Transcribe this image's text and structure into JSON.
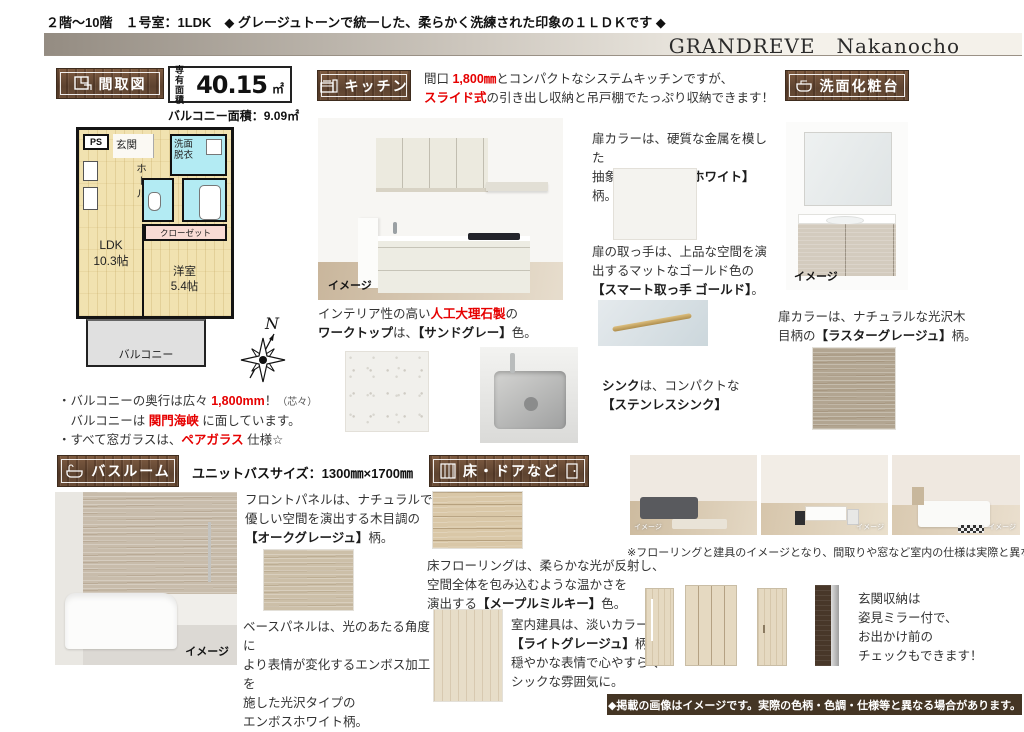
{
  "page": {
    "top_header": "２階～10階　１号室：1LDK　◆ グレージュトーンで統一した、柔らかく洗練された印象の１ＬＤＫです ◆",
    "title": "GRANDREVE　Nakanocho",
    "footer_note": "◆掲載の画像はイメージです。実際の色柄・色調・仕様等と異なる場合があります。",
    "image_label": "イメージ",
    "colors": {
      "accent_red": "#e60000",
      "plaque_wood": "#6b4a33",
      "footer_bg": "#443524"
    }
  },
  "floorplan": {
    "header": "間取図",
    "area_label": "専有\n面積",
    "area_value": "40.15",
    "area_unit": "㎡",
    "balcony_area": "バルコニー面積：9.09㎡",
    "rooms": {
      "ps": "PS",
      "genkan": "玄関",
      "hall": "ホール",
      "washroom": "洗面\n脱衣",
      "closet": "クローゼット",
      "ldk": "LDK\n10.3帖",
      "bedroom": "洋室\n5.4帖",
      "balcony": "バルコニー"
    },
    "compass": "N",
    "notes": {
      "n1_pre": "・バルコニーの奥行は広々 ",
      "n1_red": "1,800mm",
      "n1_post": "！",
      "n1_small": "（芯々）",
      "n2_pre": "　バルコニーは ",
      "n2_red": "関門海峡",
      "n2_post": " に面しています。",
      "n3_pre": "・すべて窓ガラスは、",
      "n3_red": "ペアガラス",
      "n3_post": " 仕様☆"
    }
  },
  "kitchen": {
    "header": "キッチン",
    "intro": {
      "pre": "間口 ",
      "red1": "1,800㎜",
      "mid": "とコンパクトなシステムキッチンですが、",
      "red2": "スライド式",
      "post": "の引き出し収納と吊戸棚でたっぷり収納できます！"
    },
    "worktop": {
      "l1_pre": "インテリア性の高い",
      "l1_red": "人工大理石製",
      "l1_post": "の",
      "l2_b1": "ワークトップ",
      "l2_m": "は、",
      "l2_b2": "【サンドグレー】",
      "l2_post": "色。"
    },
    "door": {
      "l1": "扉カラーは、硬質な金属を模した",
      "l2_pre": "抽象柄の",
      "l2_b": "【モードホワイト】",
      "l2_post": "柄。"
    },
    "handle": {
      "l1": "扉の取っ手は、上品な空間を演",
      "l2": "出するマットなゴールド色の",
      "l3_b": "【スマート取っ手 ゴールド】",
      "l3_post": "。"
    },
    "sink": {
      "b1": "シンク",
      "m": "は、コンパクトな",
      "b2": "【ステンレスシンク】"
    }
  },
  "vanity": {
    "header": "洗面化粧台",
    "door": {
      "l1": "扉カラーは、ナチュラルな光沢木",
      "l2_pre": "目柄の",
      "l2_b": "【ラスターグレージュ】",
      "l2_post": "柄。"
    }
  },
  "bathroom": {
    "header": "バスルーム",
    "size": "ユニットバスサイズ：1300㎜×1700㎜",
    "front": {
      "l1": "フロントパネルは、ナチュラルで",
      "l2": "優しい空間を演出する木目調の",
      "l3_b": "【オークグレージュ】",
      "l3_post": "柄。"
    },
    "base": {
      "l1": "ベースパネルは、光のあたる角度に",
      "l2": "より表情が変化するエンボス加工を",
      "l3": "施した光沢タイプの",
      "l4": "エンボスホワイト柄。"
    }
  },
  "floor_doors": {
    "header": "床・ドアなど",
    "flooring": {
      "l1": "床フローリングは、柔らかな光が反射し、",
      "l2": "空間全体を包み込むような温かさを",
      "l3_pre": "演出する",
      "l3_b": "【メープルミルキー】",
      "l3_post": "色。"
    },
    "fixtures": {
      "l1_pre": "室内建具は、淡いカラーの",
      "l2_b": "【ライトグレージュ】",
      "l2_post": "柄。",
      "l3": "穏やかな表情で心やすらぐ",
      "l4": "シックな雰囲気に。"
    },
    "photos_note": "※フローリングと建具のイメージとなり、間取りや窓など室内の仕様は実際と異なります。",
    "entrance": {
      "l1": "玄関収納は",
      "l2": "姿見ミラー付で、",
      "l3": "お出かけ前の",
      "l4": "チェックもできます！"
    }
  }
}
